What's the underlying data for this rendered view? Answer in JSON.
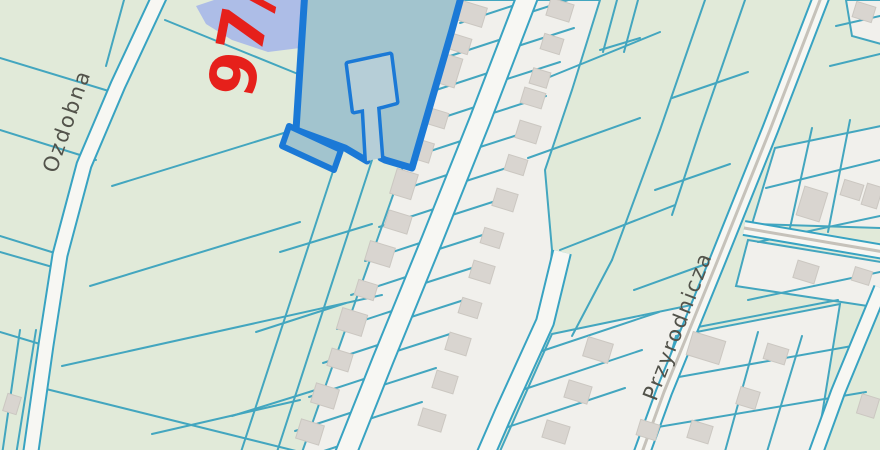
{
  "map": {
    "colors": {
      "background": "#e1ead9",
      "parcel_line": "#43a6bf",
      "band_fill": "#f1f0ec",
      "road_fill": "#f7f7f3",
      "road_casing": "#38a3c2",
      "road_centerline": "#c6c2ba",
      "water_fill": "#adbde7",
      "building_fill": "#d9d5d0",
      "building_edge": "#cbc7c1",
      "selected_fill": "#a2c4ce",
      "selected_notch_fill": "#b6ced7",
      "selected_stroke": "#1b79d6",
      "street_label": "#52524a",
      "parcel_number": "#e6201b"
    },
    "labels": {
      "ozdobna": {
        "text": "Ozdobna",
        "x": 56,
        "y": 174,
        "rot": -71
      },
      "przyrodnicza": {
        "text": "Przyrodnicza",
        "x": 656,
        "y": 402,
        "rot": -69
      },
      "parcel_number": {
        "text": "97/",
        "x": 252,
        "y": 100,
        "rot": -79
      }
    },
    "water": {
      "pond_points": "196,6 214,0 312,0 310,24 300,48 268,52 232,40 206,24"
    },
    "selected_parcel": {
      "main_points": "305,-10 463,-10 452,30 412,168 385,160 381,158 377,107 396,102 390,55 348,64 354,111 364,109 367,161 345,148 296,130",
      "notch_points": "364,109 377,107 396,102 390,55 348,64 354,111 364,109 367,161 381,158 377,107",
      "strip_points": "289,126 341,150 334,170 282,146"
    },
    "bands": [
      {
        "name": "band-west-of-central-road",
        "points": "462,0 530,0 482,120 434,240 385,360 346,458 300,458"
      },
      {
        "name": "band-east-of-central-road",
        "points": "530,0 600,0 572,90 545,170 552,250 545,330 503,412 483,458 346,458 385,360 434,240 482,120"
      },
      {
        "name": "band-southeast-block",
        "points": "552,334 706,302 640,458 497,458"
      },
      {
        "name": "block-east-of-przyrodnicza-upper",
        "points": "775,148 881,126 881,228 752,224"
      },
      {
        "name": "block-east-of-przyrodnicza-lower",
        "points": "748,240 881,262 881,308 736,286"
      },
      {
        "name": "block-northeast-corner",
        "points": "846,0 881,0 881,44 852,36"
      },
      {
        "name": "block-bottom-right",
        "points": "676,336 840,304 815,458 642,458"
      }
    ],
    "roads": [
      {
        "name": "Ozdobna",
        "points": "160,-5 118,85 84,165 60,255 46,345 30,458",
        "width": 13,
        "centerline": false
      },
      {
        "name": "central-road",
        "points": "528,-5 480,120 432,240 383,360 344,458",
        "width": 19,
        "centerline": false
      },
      {
        "name": "side-road-south",
        "points": "562,252 545,322 504,412 484,458",
        "width": 16,
        "centerline": false
      },
      {
        "name": "Przyrodnicza",
        "points": "822,-5 770,130 717,262 664,392 640,458",
        "width": 14,
        "centerline": true
      },
      {
        "name": "road-bottom-right",
        "points": "881,288 838,392 814,458",
        "width": 12,
        "centerline": false
      },
      {
        "name": "gray-cross-road",
        "points": "744,228 884,252",
        "width": 12,
        "centerline": true
      }
    ],
    "parcel_lines": [
      [
        0,
        58,
        112,
        92
      ],
      [
        0,
        130,
        96,
        160
      ],
      [
        0,
        236,
        58,
        254
      ],
      [
        0,
        252,
        56,
        268
      ],
      [
        0,
        332,
        40,
        344
      ],
      [
        124,
        0,
        106,
        66
      ],
      [
        20,
        330,
        2,
        455
      ],
      [
        36,
        330,
        16,
        455
      ],
      [
        165,
        20,
        298,
        74
      ],
      [
        112,
        186,
        300,
        128
      ],
      [
        90,
        286,
        300,
        222
      ],
      [
        62,
        366,
        382,
        295
      ],
      [
        34,
        386,
        300,
        452
      ],
      [
        152,
        434,
        300,
        400
      ],
      [
        280,
        252,
        372,
        224
      ],
      [
        256,
        332,
        346,
        303
      ],
      [
        232,
        416,
        322,
        388
      ],
      [
        338,
        156,
        240,
        455
      ],
      [
        372,
        160,
        276,
        455
      ],
      [
        617,
        0,
        603,
        52
      ],
      [
        638,
        0,
        624,
        52
      ],
      [
        600,
        50,
        640,
        38
      ],
      [
        547,
        78,
        660,
        32
      ],
      [
        560,
        250,
        675,
        205
      ],
      [
        528,
        158,
        640,
        118
      ],
      [
        705,
        0,
        660,
        130
      ],
      [
        660,
        130,
        612,
        260
      ],
      [
        612,
        260,
        572,
        336
      ],
      [
        745,
        0,
        700,
        130
      ],
      [
        700,
        130,
        672,
        215
      ],
      [
        672,
        98,
        748,
        72
      ],
      [
        655,
        190,
        730,
        164
      ],
      [
        634,
        290,
        706,
        264
      ],
      [
        766,
        188,
        880,
        160
      ],
      [
        758,
        242,
        880,
        216
      ],
      [
        748,
        300,
        880,
        272
      ],
      [
        836,
        26,
        880,
        16
      ],
      [
        830,
        66,
        880,
        54
      ],
      [
        812,
        128,
        790,
        228
      ],
      [
        850,
        120,
        828,
        232
      ],
      [
        672,
        332,
        838,
        300
      ],
      [
        662,
        380,
        852,
        346
      ],
      [
        652,
        428,
        866,
        392
      ],
      [
        758,
        332,
        724,
        455
      ],
      [
        802,
        336,
        766,
        455
      ],
      [
        518,
        4,
        460,
        23
      ],
      [
        505,
        38,
        447,
        57
      ],
      [
        491,
        72,
        433,
        91
      ],
      [
        478,
        106,
        420,
        125
      ],
      [
        464,
        140,
        406,
        159
      ],
      [
        450,
        174,
        392,
        193
      ],
      [
        437,
        208,
        379,
        227
      ],
      [
        423,
        242,
        365,
        261
      ],
      [
        409,
        276,
        351,
        295
      ],
      [
        395,
        310,
        337,
        329
      ],
      [
        381,
        344,
        323,
        363
      ],
      [
        367,
        378,
        309,
        397
      ],
      [
        353,
        412,
        295,
        431
      ],
      [
        339,
        446,
        281,
        465
      ],
      [
        531,
        12,
        587,
        -6
      ],
      [
        518,
        46,
        574,
        28
      ],
      [
        504,
        80,
        560,
        62
      ],
      [
        490,
        114,
        546,
        96
      ],
      [
        477,
        148,
        533,
        130
      ],
      [
        463,
        182,
        519,
        164
      ],
      [
        449,
        216,
        505,
        198
      ],
      [
        436,
        250,
        492,
        232
      ],
      [
        422,
        284,
        478,
        266
      ],
      [
        408,
        318,
        464,
        300
      ],
      [
        394,
        352,
        450,
        334
      ],
      [
        380,
        386,
        436,
        368
      ],
      [
        366,
        420,
        422,
        402
      ],
      [
        539,
        352,
        659,
        312
      ],
      [
        522,
        390,
        642,
        350
      ],
      [
        505,
        428,
        625,
        388
      ]
    ],
    "buildings": [
      [
        472,
        14,
        26,
        20
      ],
      [
        460,
        44,
        20,
        16
      ],
      [
        447,
        70,
        24,
        30
      ],
      [
        436,
        118,
        22,
        16
      ],
      [
        420,
        150,
        24,
        20
      ],
      [
        404,
        184,
        22,
        26
      ],
      [
        398,
        222,
        24,
        18
      ],
      [
        380,
        254,
        26,
        20
      ],
      [
        366,
        290,
        20,
        16
      ],
      [
        352,
        322,
        26,
        22
      ],
      [
        340,
        360,
        22,
        18
      ],
      [
        325,
        396,
        24,
        20
      ],
      [
        310,
        432,
        24,
        20
      ],
      [
        560,
        10,
        24,
        18
      ],
      [
        552,
        44,
        20,
        16
      ],
      [
        540,
        78,
        18,
        16
      ],
      [
        533,
        98,
        22,
        16
      ],
      [
        528,
        132,
        22,
        18
      ],
      [
        516,
        165,
        20,
        16
      ],
      [
        505,
        200,
        22,
        18
      ],
      [
        492,
        238,
        20,
        16
      ],
      [
        482,
        272,
        22,
        18
      ],
      [
        470,
        308,
        20,
        16
      ],
      [
        458,
        344,
        22,
        18
      ],
      [
        445,
        382,
        22,
        18
      ],
      [
        432,
        420,
        24,
        18
      ],
      [
        598,
        350,
        26,
        20
      ],
      [
        578,
        392,
        24,
        18
      ],
      [
        556,
        432,
        24,
        18
      ],
      [
        648,
        430,
        20,
        16
      ],
      [
        812,
        204,
        24,
        30
      ],
      [
        852,
        190,
        20,
        16
      ],
      [
        806,
        272,
        22,
        18
      ],
      [
        862,
        276,
        18,
        14
      ],
      [
        864,
        12,
        20,
        16
      ],
      [
        872,
        196,
        16,
        22
      ],
      [
        706,
        348,
        34,
        24
      ],
      [
        776,
        354,
        22,
        16
      ],
      [
        748,
        398,
        20,
        18
      ],
      [
        700,
        432,
        22,
        18
      ],
      [
        868,
        406,
        18,
        20
      ],
      [
        12,
        404,
        14,
        18
      ]
    ]
  }
}
